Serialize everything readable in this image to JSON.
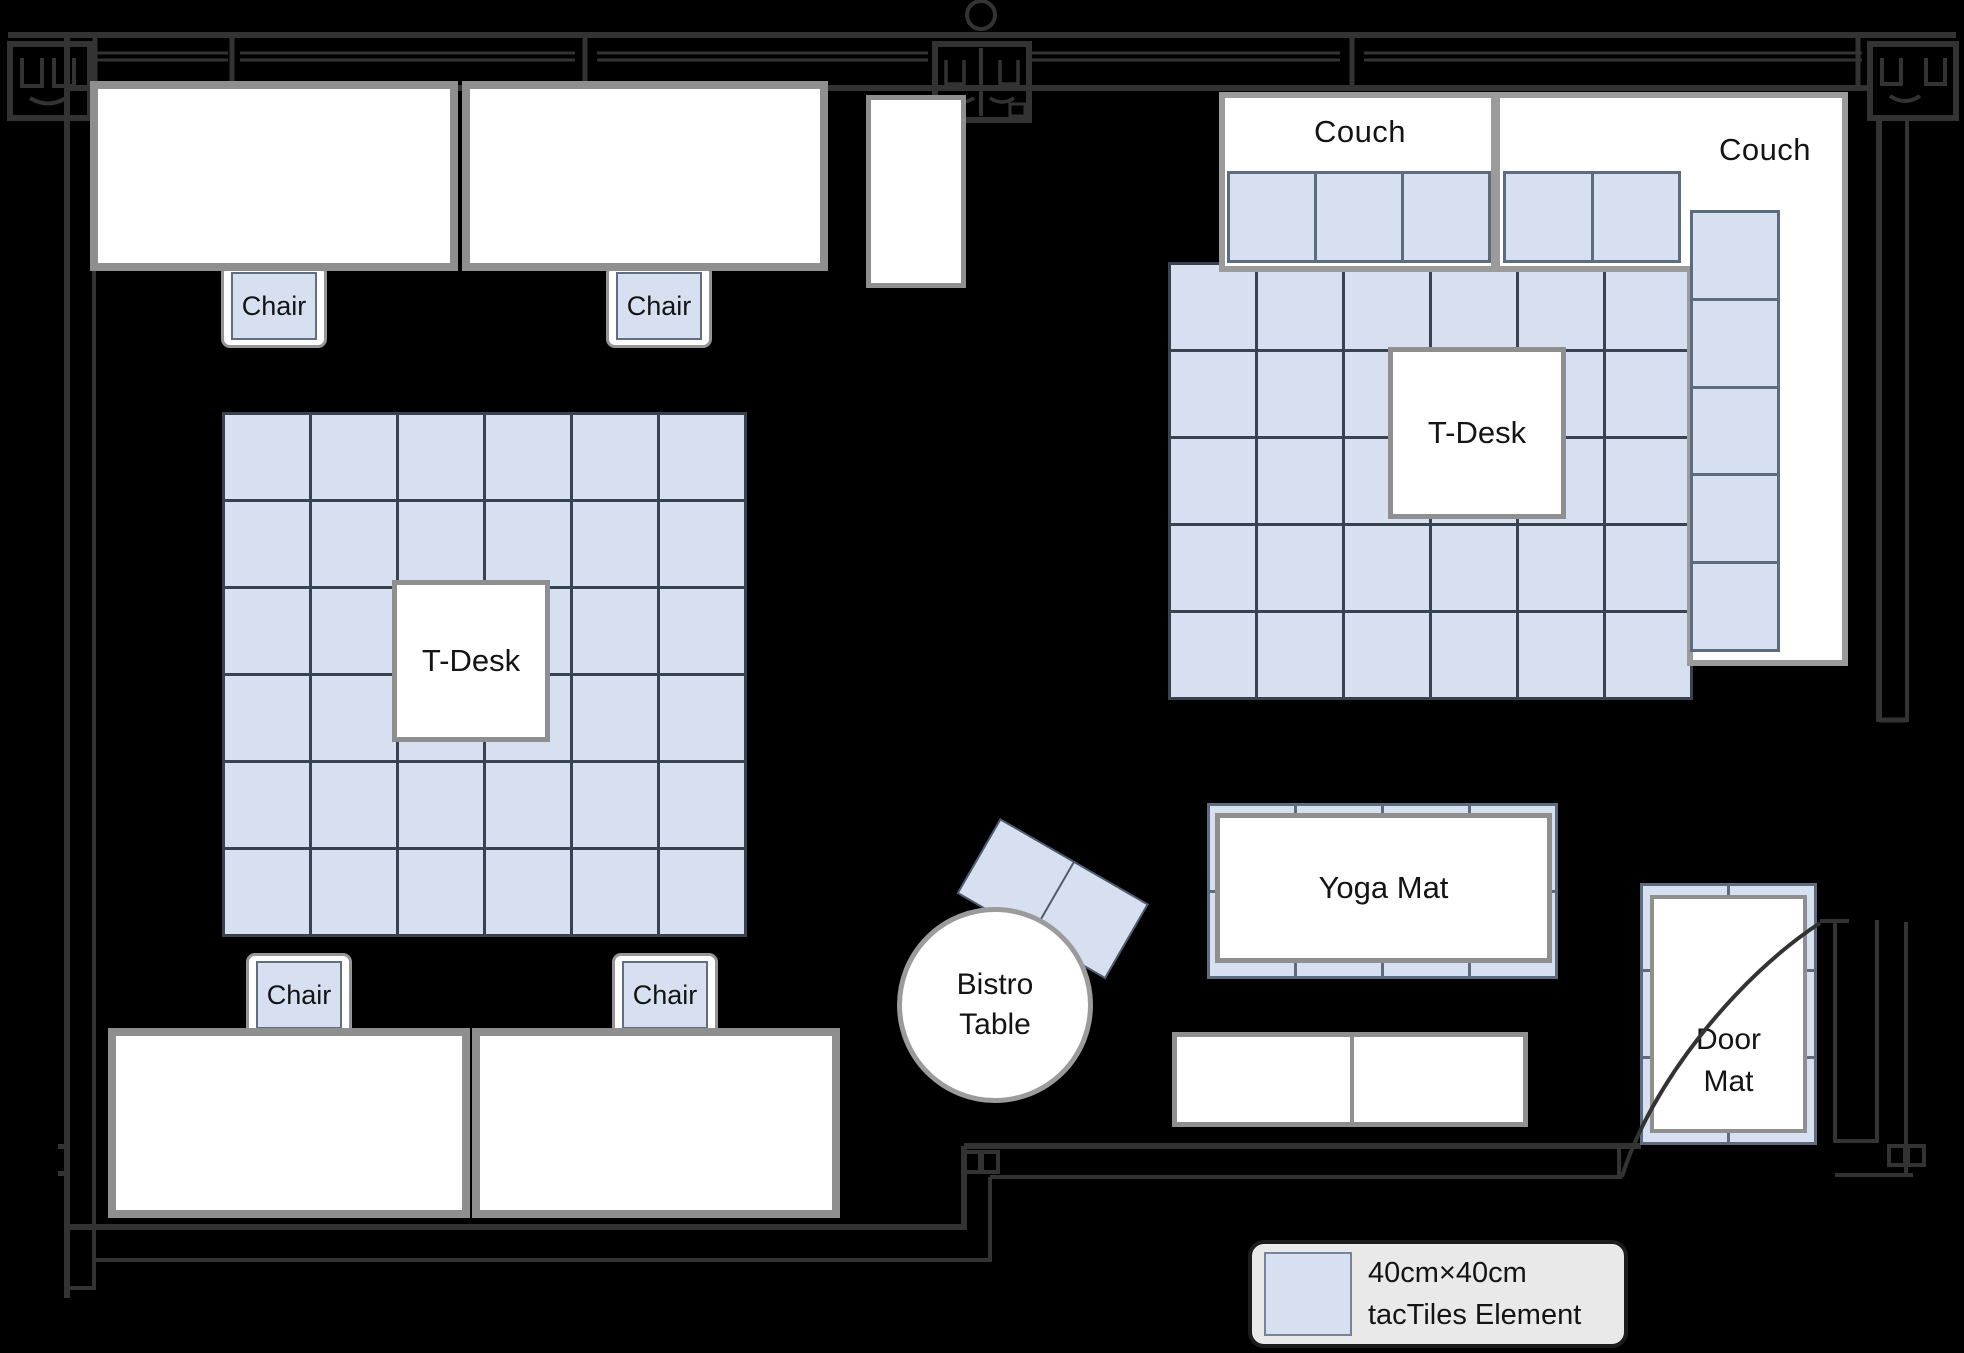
{
  "title": "Office floor plan with tacTiles layout",
  "colors": {
    "background": "#000000",
    "wall": "#333333",
    "furniture_border": "#8f8f8f",
    "couch_border": "#9b9b9b",
    "tile_fill": "#d7e0f1",
    "tile_border_dark": "#37434f",
    "tile_border_soft": "#5c6b7d",
    "legend_fill": "#e9e9e9",
    "text": "#141414"
  },
  "labels": {
    "chair": "Chair",
    "tdesk": "T-Desk",
    "couch": "Couch",
    "yoga_mat": "Yoga Mat",
    "bistro_line1": "Bistro",
    "bistro_line2": "Table",
    "door_line1": "Door",
    "door_line2": "Mat"
  },
  "legend": {
    "line1": "40cm×40cm",
    "line2": "tacTiles Element"
  },
  "grids": {
    "left_floor": {
      "cols": 6,
      "rows": 6
    },
    "right_floor": {
      "cols": 6,
      "rows": 5
    },
    "couch_left_seat": {
      "cols": 3,
      "rows": 1
    },
    "couch_right_seat": {
      "cols": 2,
      "rows": 1
    },
    "couch_right_column": {
      "cols": 1,
      "rows": 5
    },
    "yoga_base": {
      "cols": 4,
      "rows": 2
    },
    "door_base": {
      "cols": 2,
      "rows": 3
    },
    "bistro_tiles": {
      "cols": 2,
      "rows": 1
    }
  }
}
